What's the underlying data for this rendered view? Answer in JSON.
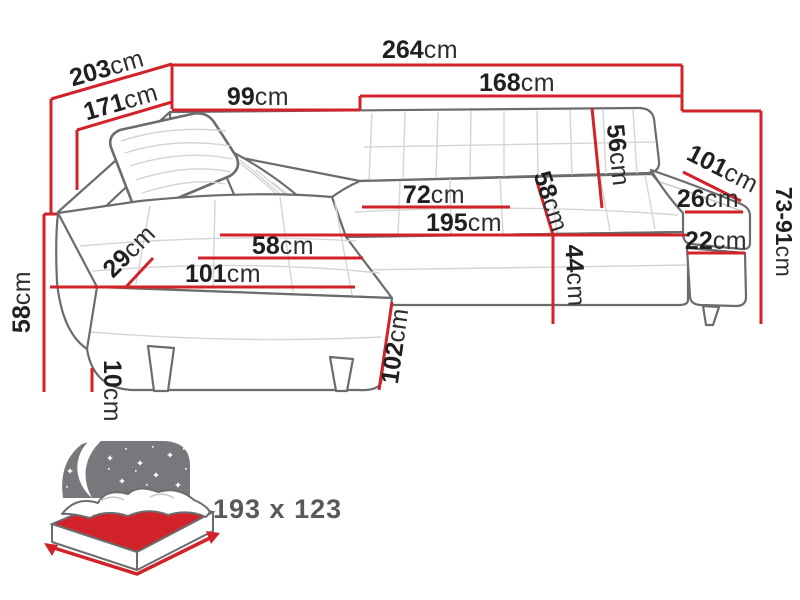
{
  "diagram": {
    "title": "corner-sofa-dimension-diagram",
    "colors": {
      "dimension_red": "#d2232a",
      "text_black": "#231f20",
      "sofa_outline_gray": "#6b6c6e",
      "sofa_detail_gray": "#d4d5d7",
      "icon_gray": "#77787b",
      "icon_label_gray": "#58595b"
    },
    "dims": {
      "back_total_width": {
        "num": "264",
        "unit": "cm"
      },
      "total_depth": {
        "num": "203",
        "unit": "cm"
      },
      "chaise_total_length": {
        "num": "171",
        "unit": "cm"
      },
      "corner_back_width": {
        "num": "99",
        "unit": "cm"
      },
      "right_back_width": {
        "num": "168",
        "unit": "cm"
      },
      "backrest_height": {
        "num": "56",
        "unit": "cm"
      },
      "armrest_length": {
        "num": "101",
        "unit": "cm"
      },
      "armrest_width": {
        "num": "26",
        "unit": "cm"
      },
      "overall_height": {
        "num": "73-91",
        "unit": "cm"
      },
      "armrest_ledge_height": {
        "num": "22",
        "unit": "cm"
      },
      "seat_depth": {
        "num": "72",
        "unit": "cm"
      },
      "backrest_depth": {
        "num": "58",
        "unit": "cm"
      },
      "seat_total_width": {
        "num": "195",
        "unit": "cm"
      },
      "seat_height": {
        "num": "44",
        "unit": "cm"
      },
      "side_height": {
        "num": "58",
        "unit": "cm"
      },
      "chaise_back_offset": {
        "num": "29",
        "unit": "cm"
      },
      "chaise_seat_width": {
        "num": "58",
        "unit": "cm"
      },
      "chaise_seat_length": {
        "num": "101",
        "unit": "cm"
      },
      "chaise_front_length": {
        "num": "102",
        "unit": "cm"
      },
      "leg_height": {
        "num": "10",
        "unit": "cm"
      }
    },
    "sleeping_area": {
      "label": "193 x 123"
    }
  }
}
